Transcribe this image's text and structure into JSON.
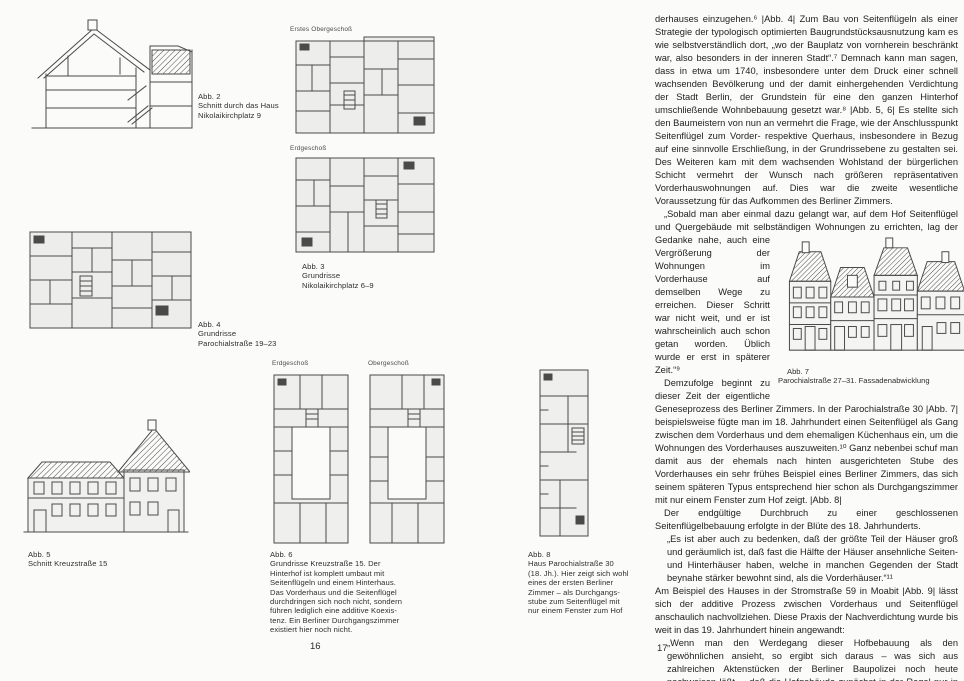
{
  "colors": {
    "page_background": "#fbfbfa",
    "text_ink": "#222222",
    "drawing_line": "#4a4a48"
  },
  "left_page": {
    "page_number": "16",
    "fig3_labels": {
      "upper": "Erstes Obergeschoß",
      "lower": "Erdgeschoß"
    },
    "fig6_labels": {
      "left": "Erdgeschoß",
      "right": "Obergeschoß"
    },
    "captions": {
      "fig2": "Abb. 2\nSchnitt durch das Haus\nNikolaikirchplatz 9",
      "fig3": "Abb. 3\nGrundrisse\nNikolaikirchplatz 6–9",
      "fig4": "Abb. 4\nGrundrisse\nParochialstraße 19–23",
      "fig5": "Abb. 5\nSchnitt Kreuzstraße 15",
      "fig6": "Abb. 6\nGrundrisse Kreuzstraße 15. Der\nHinterhof ist komplett umbaut mit\nSeitenflügeln und einem Hinterhaus.\nDas Vorderhaus und die Seitenflügel\ndurchdringen sich noch nicht, sondern\nführen lediglich eine additive Koexis-\ntenz. Ein Berliner Durchgangszimmer\nexistiert hier noch nicht.",
      "fig8": "Abb. 8\nHaus Parochialstraße 30\n(18. Jh.). Hier zeigt sich wohl\neines der ersten Berliner\nZimmer – als Durchgangs-\nstube zum Seitenflügel mit\nnur einem Fenster zum Hof"
    }
  },
  "right_page": {
    "page_number": "17",
    "fig7_caption": "Abb. 7\nParochialstraße 27–31. Fassadenabwicklung",
    "paragraphs": {
      "p1": "derhauses einzugehen.⁶ |Abb. 4| Zum Bau von Seitenflügeln als einer Strategie der typologisch optimierten Baugrundstücksausnutzung kam es wie selbstverständlich dort, „wo der Bauplatz von vornherein beschränkt war, also besonders in der inneren Stadt“.⁷ Demnach kann man sagen, dass in etwa um 1740, insbesondere unter dem Druck einer schnell wachsenden Bevölkerung und der damit einhergehenden Verdichtung der Stadt Berlin, der Grundstein für eine den ganzen Hinterhof umschließende Wohnbebauung gesetzt war.⁸ |Abb. 5, 6| Es stellte sich den Baumeistern von nun an vermehrt die Frage, wie der Anschlusspunkt Seitenflügel zum Vorder- respektive Querhaus, insbesondere in Bezug auf eine sinnvolle Erschließung, in der Grundrissebene zu gestalten sei. Des Weiteren kam mit dem wachsenden Wohlstand der bürgerlichen Schicht vermehrt der Wunsch nach größeren repräsentativen Vorderhauswohnungen auf. Dies war die zweite wesentliche Voraussetzung für das Aufkommen des Berliner Zimmers.",
      "p2a": "„Sobald man aber einmal dazu gelangt war, auf dem Hof Seitenflügel und Quergebäude mit selbständigen Wohnungen zu errichten, ",
      "p2b": "lag der Gedanke nahe, auch eine Vergrößerung der Wohnungen im Vorderhause auf demselben Wege zu erreichen. Dieser Schritt war nicht weit, und er ist wahrscheinlich auch schon getan worden. Üblich wurde er erst in späterer Zeit.“⁹",
      "p3": "Demzufolge beginnt zu dieser Zeit der eigentliche Geneseprozess des Berliner Zimmers. In der Parochialstraße 30 |Abb. 7| beispielsweise fügte man im 18. Jahrhundert einen Seitenflügel als Gang zwischen dem Vorderhaus und dem ehemaligen Küchenhaus ein, um die Wohnungen des Vorderhauses auszuweiten.¹⁰ Ganz nebenbei schuf man damit aus der ehemals nach hinten ausgerichteten Stube des Vorderhauses ein sehr frühes Beispiel eines Berliner Zimmers, das sich seinem späteren Typus entsprechend hier schon als Durchgangszimmer mit nur einem Fenster zum Hof zeigt. |Abb. 8|",
      "p4": "Der endgültige Durchbruch zu einer geschlossenen Seitenflügelbebauung erfolgte in der Blüte des 18. Jahrhunderts.",
      "p5": "„Es ist aber auch zu bedenken, daß der größte Teil der Häuser groß und geräumlich ist, daß fast die Hälfte der Häuser ansehnliche Seiten- und Hinterhäuser haben, welche in manchen Gegenden der Stadt beynahe stärker bewohnt sind, als die Vorderhäuser.“¹¹",
      "p6": "Am Beispiel des Hauses in der Stromstraße 59 in Moabit |Abb. 9| lässt sich der additive Prozess zwischen Vorderhaus und Seitenflügel anschaulich nachvollziehen. Diese Praxis der Nachverdichtung wurde bis weit in das 19. Jahrhundert hinein angewandt:",
      "p7": "„Wenn man den Werdegang dieser Hofbebauung als den gewöhnlichen ansieht, so ergibt sich daraus – was sich aus zahlreichen Aktenstücken der Berliner Baupolizei noch heute nachweisen läßt –, daß die Hofgebäude zunächst in der Regel nur in bescheidener Höhe von ein"
    }
  }
}
